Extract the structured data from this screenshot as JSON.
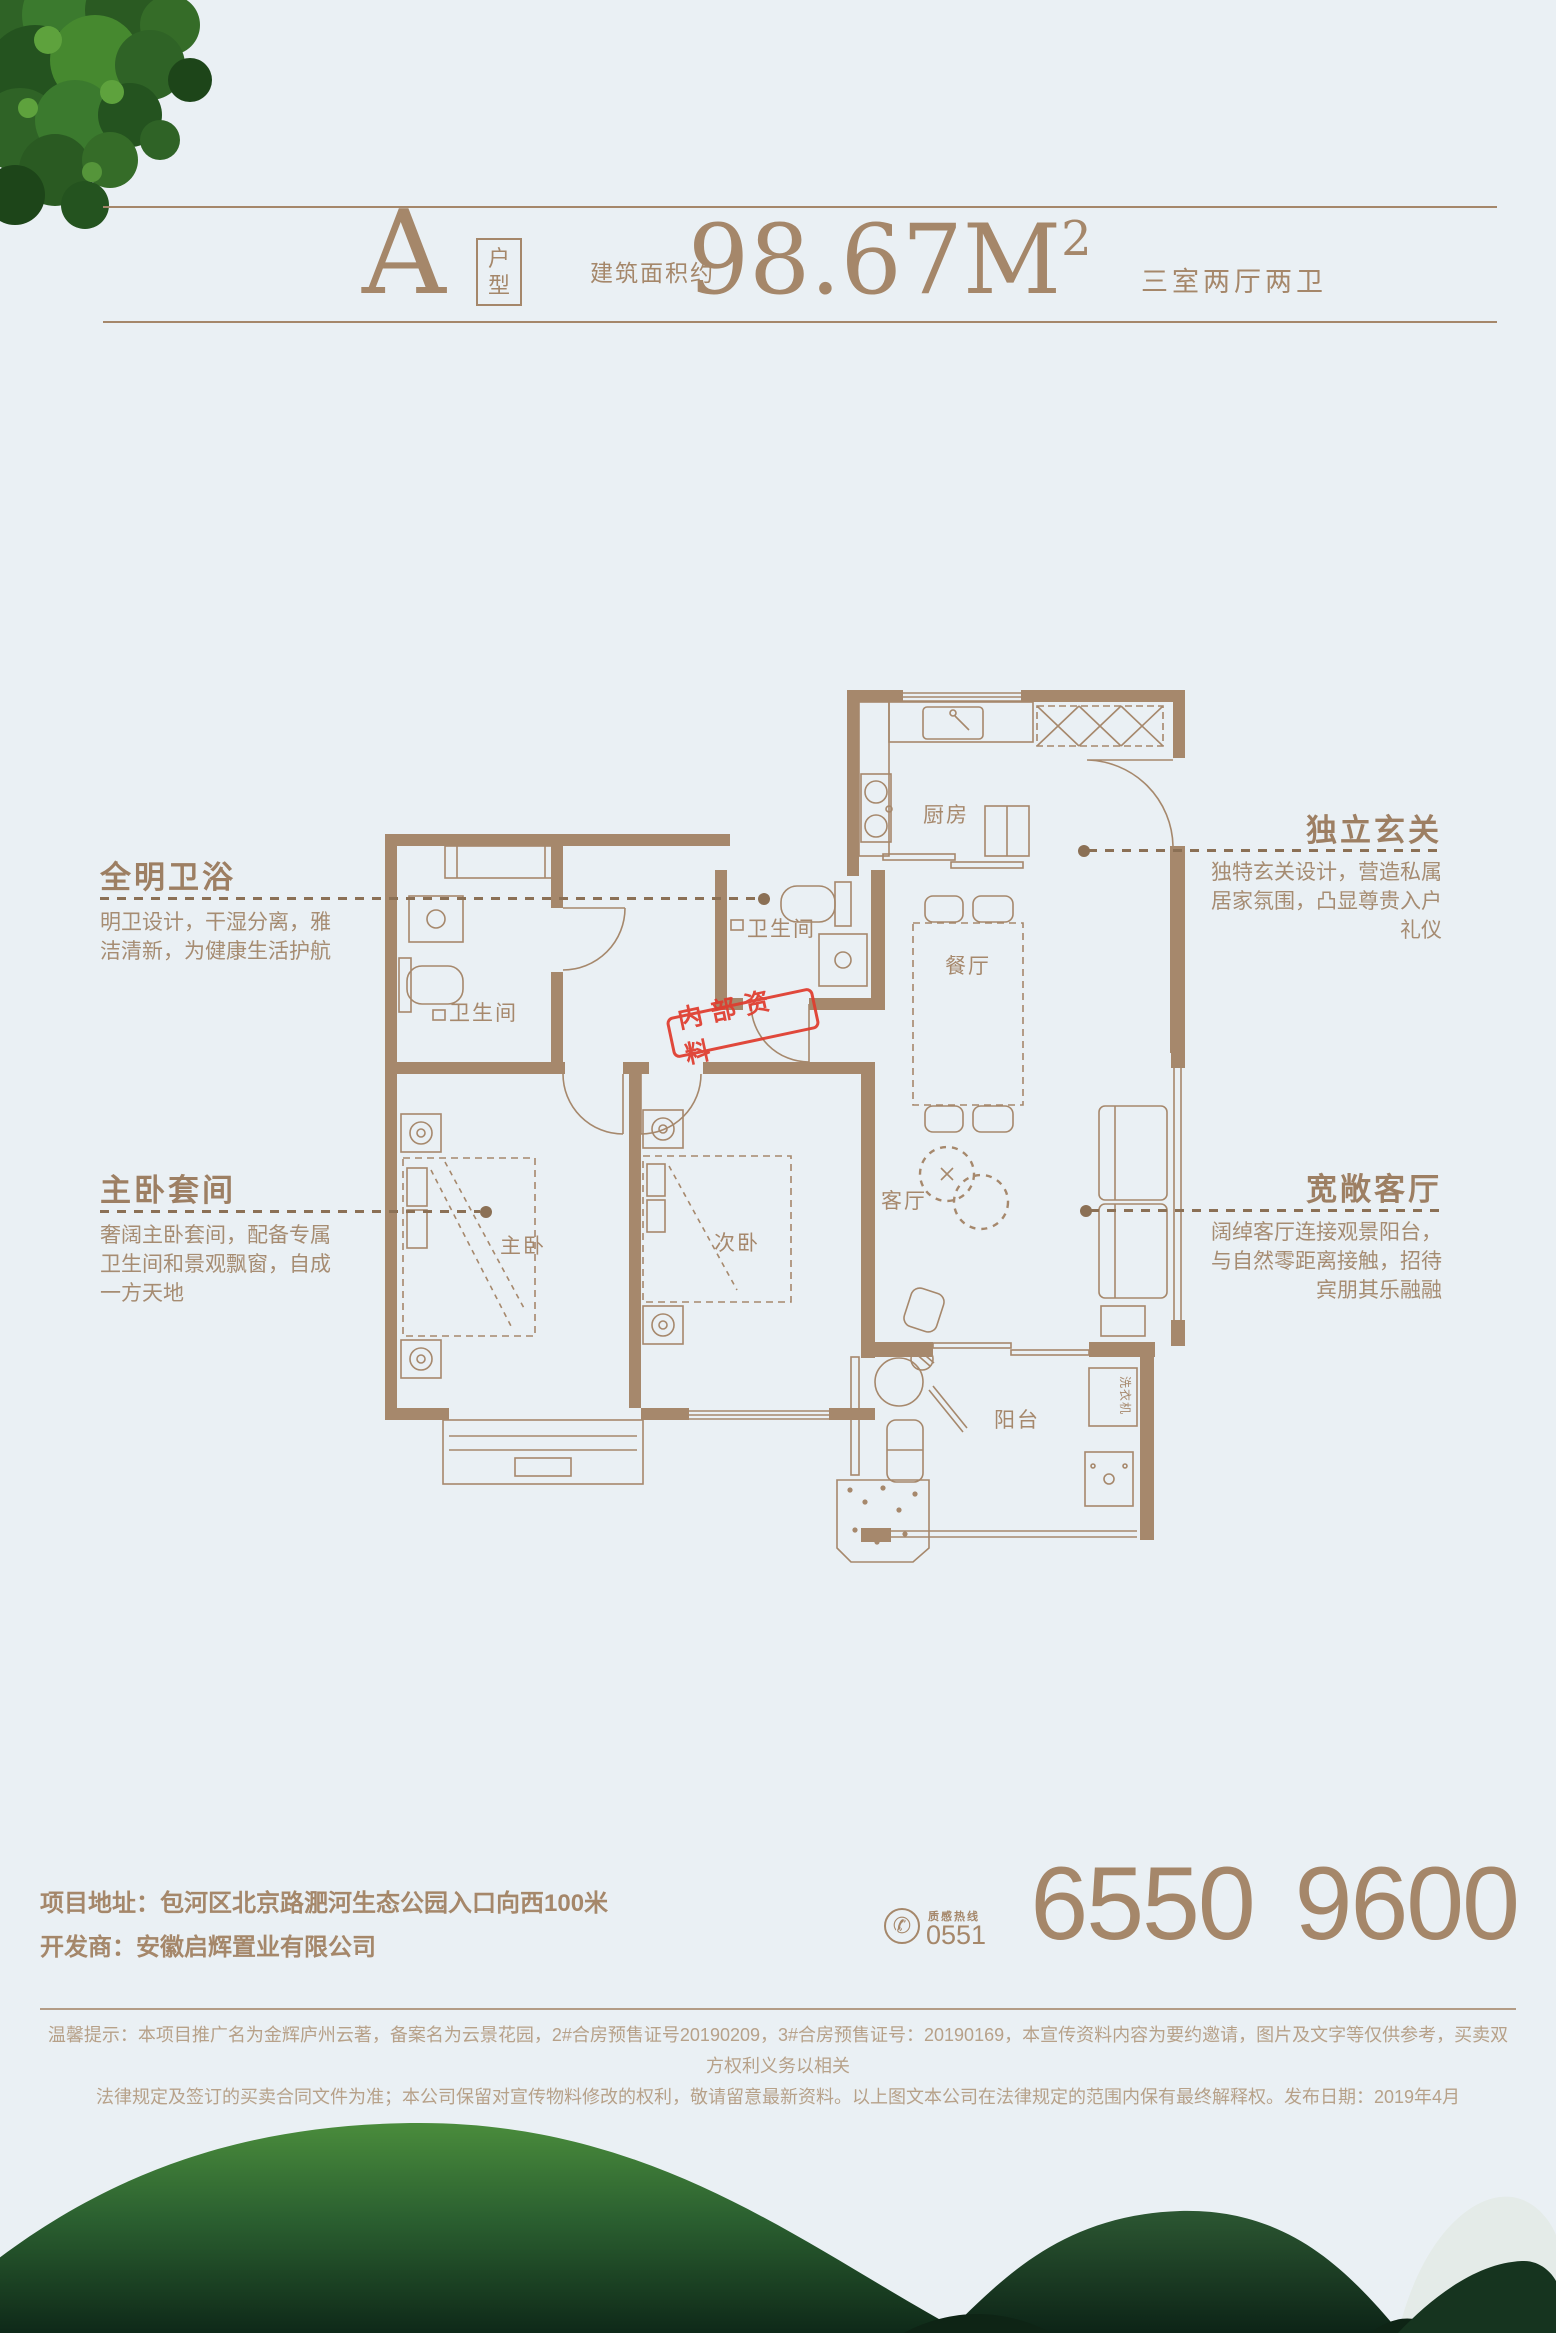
{
  "header": {
    "plan_letter": "A",
    "plan_label": "户型",
    "area_prefix": "建筑面积约",
    "area_value": "98.67M",
    "area_sup": "2",
    "rooms_summary": "三室两厅两卫"
  },
  "floorplan": {
    "stamp": "内部资料",
    "rooms": {
      "kitchen": "厨房",
      "dining": "餐厅",
      "bath_main": "卫生间",
      "bath_master": "卫生间",
      "master_bedroom": "主卧",
      "second_bedroom": "次卧",
      "living": "客厅",
      "balcony": "阳台",
      "washer": "洗衣机"
    }
  },
  "annotations": {
    "left": [
      {
        "title": "全明卫浴",
        "body": "明卫设计，干湿分离，雅\n洁清新，为健康生活护航"
      },
      {
        "title": "主卧套间",
        "body": "奢阔主卧套间，配备专属\n卫生间和景观飘窗，自成\n一方天地"
      }
    ],
    "right": [
      {
        "title": "独立玄关",
        "body": "独特玄关设计，营造私属\n居家氛围，凸显尊贵入户\n礼仪"
      },
      {
        "title": "宽敞客厅",
        "body": "阔绰客厅连接观景阳台，\n与自然零距离接触，招待\n宾朋其乐融融"
      }
    ]
  },
  "footer": {
    "address_label": "项目地址：",
    "address": "包河区北京路淝河生态公园入口向西100米",
    "developer_label": "开发商：",
    "developer": "安徽启辉置业有限公司",
    "phone_icon_glyph": "✆",
    "hotline_label": "质感热线",
    "hotline_area_code": "0551",
    "phone": "6550 9600",
    "disclaimer": "温馨提示：本项目推广名为金辉庐州云著，备案名为云景花园，2#合房预售证号20190209，3#合房预售证号：20190169，本宣传资料内容为要约邀请，图片及文字等仅供参考，买卖双方权利义务以相关\n法律规定及签订的买卖合同文件为准；本公司保留对宣传物料修改的权利，敬请留意最新资料。以上图文本公司在法律规定的范围内保有最终解释权。发布日期：2019年4月"
  },
  "colors": {
    "accent_brown": "#a5876a",
    "stamp_red": "#e03c2e",
    "background": "#eaf0f4",
    "mountain_green": "#2b6030"
  }
}
